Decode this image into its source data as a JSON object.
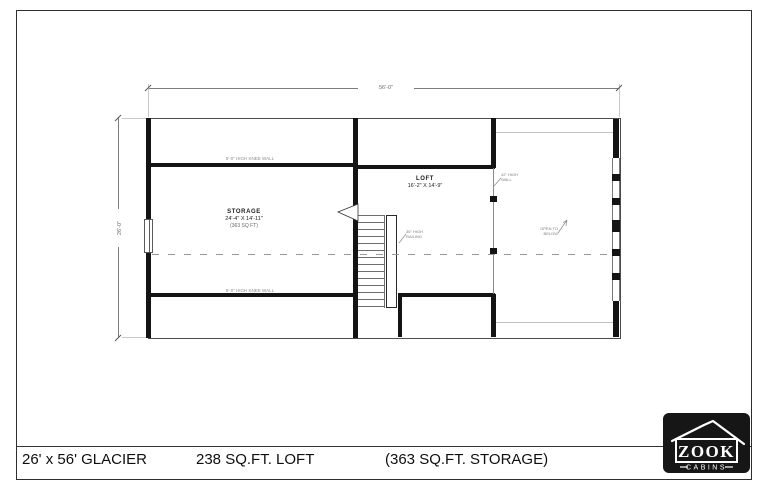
{
  "sheet": {
    "model_label": "26' x 56' GLACIER",
    "loft_label": "238 SQ.FT. LOFT",
    "storage_label": "(363 SQ.FT. STORAGE)"
  },
  "logo": {
    "brand": "ZOOK",
    "sub": "CABINS"
  },
  "plan": {
    "dim_width": "56'-0\"",
    "dim_height": "26'-0\"",
    "storage": {
      "name": "STORAGE",
      "size": "24'-4\" X 14'-11\"",
      "area": "(363 SQ FT)"
    },
    "loft": {
      "name": "LOFT",
      "size": "16'-2\" X 14'-9\""
    },
    "notes": {
      "knee_top": "5'-0\" HIGH KNEE WALL",
      "knee_bottom": "5'-0\" HIGH KNEE WALL",
      "railing_1": "36\" HIGH",
      "railing_2": "RAILING",
      "wall_1": "42\" HIGH",
      "wall_2": "WALL",
      "open_1": "OPEN TO",
      "open_2": "BELOW"
    }
  }
}
